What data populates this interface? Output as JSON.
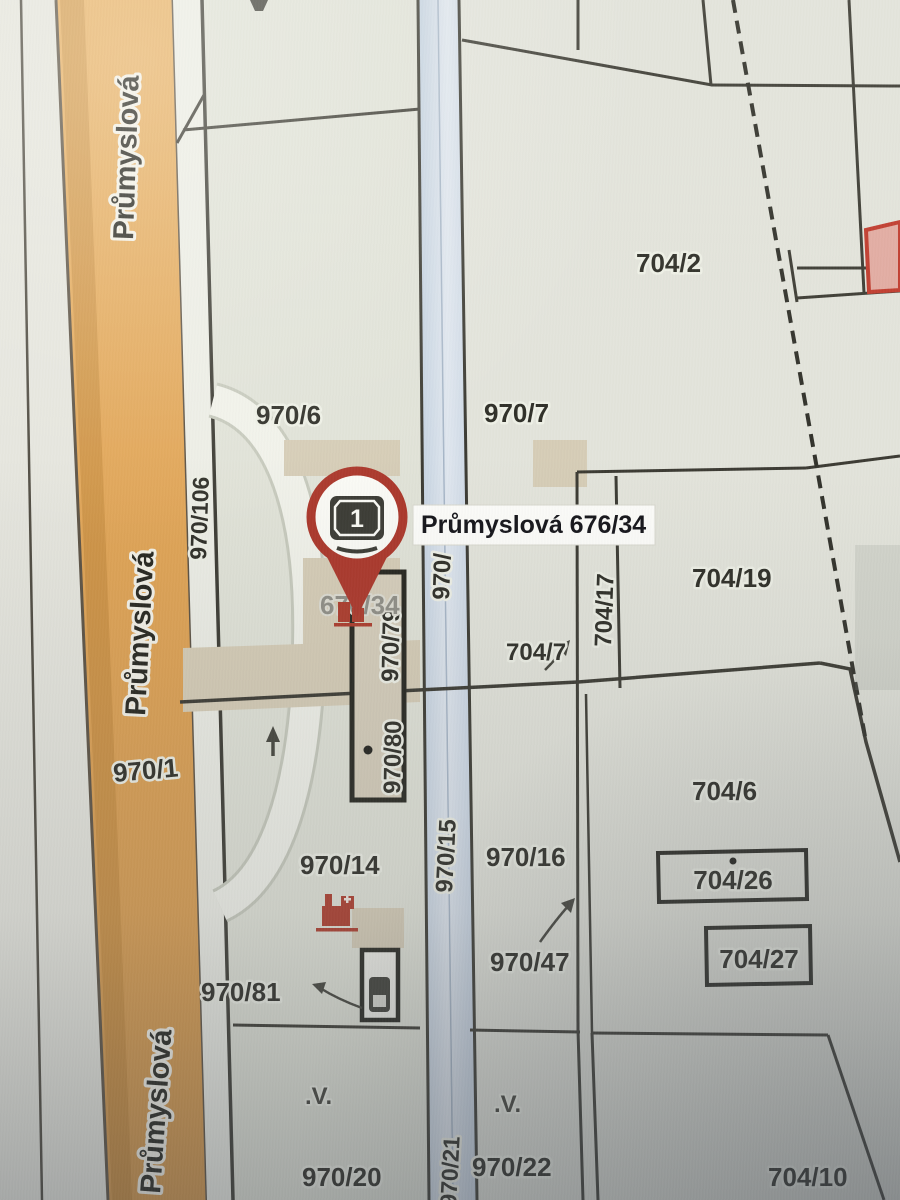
{
  "map": {
    "road_name": "Průmyslová",
    "pin": {
      "count": "1",
      "label": "Průmyslová 676/34",
      "parcel_gray": "676/34"
    },
    "parcels": {
      "p970_1": "970/1",
      "p970_6": "970/6",
      "p970_7": "970/7",
      "p970_14": "970/14",
      "p970_15": "970/15",
      "p970_16": "970/16",
      "p970_20": "970/20",
      "p970_21": "970/21",
      "p970_22": "970/22",
      "p970_47": "970/47",
      "p970_79": "970/79",
      "p970_80": "970/80",
      "p970_81": "970/81",
      "p970_106": "970/106",
      "p970_stream": "970/",
      "p704_2": "704/2",
      "p704_6": "704/6",
      "p704_7": "704/7",
      "p704_10": "704/10",
      "p704_17": "704/17",
      "p704_19": "704/19",
      "p704_26": "704/26",
      "p704_27": "704/27"
    },
    "symbols": {
      "scrub": ".V."
    },
    "colors": {
      "road_orange": "#dfa255",
      "stream_blue": "#c9d6e4",
      "parcel_fill": "#e3e4db",
      "building_beige": "#d6cdb7",
      "boundary": "#3c3b33",
      "pin_red": "#ac382b",
      "highlight_red": "#c03a2c"
    }
  }
}
